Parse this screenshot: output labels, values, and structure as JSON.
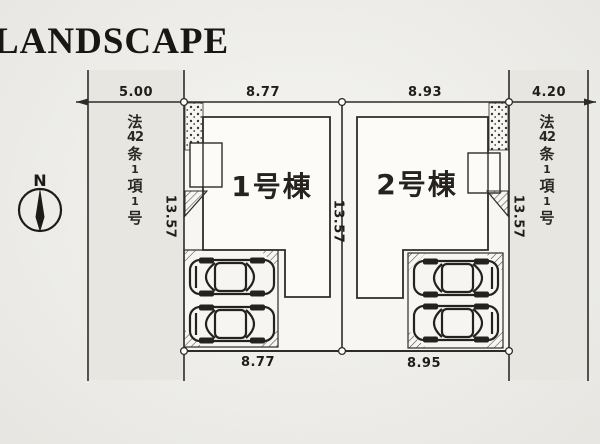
{
  "page": {
    "title": "LANDSCAPE"
  },
  "compass": {
    "north_label": "N"
  },
  "roads": {
    "left": {
      "designation": "法42条1項1号",
      "chars": [
        "法",
        "42",
        "条",
        "1",
        "項",
        "1",
        "号"
      ]
    },
    "right": {
      "designation": "法42条1項1号",
      "chars": [
        "法",
        "42",
        "条",
        "1",
        "項",
        "1",
        "号"
      ]
    }
  },
  "buildings": [
    {
      "label": "1号棟"
    },
    {
      "label": "2号棟"
    }
  ],
  "dimensions": {
    "top": [
      "5.00",
      "8.77",
      "8.93",
      "4.20"
    ],
    "bottom": [
      "8.77",
      "8.95"
    ],
    "depth": [
      "13.57",
      "13.57",
      "13.57"
    ]
  },
  "colors": {
    "line": "#2e2c29",
    "road_fill": "#e8e6e1",
    "lot_fill": "#f7f6f2",
    "building_fill": "#fcfbf8"
  }
}
